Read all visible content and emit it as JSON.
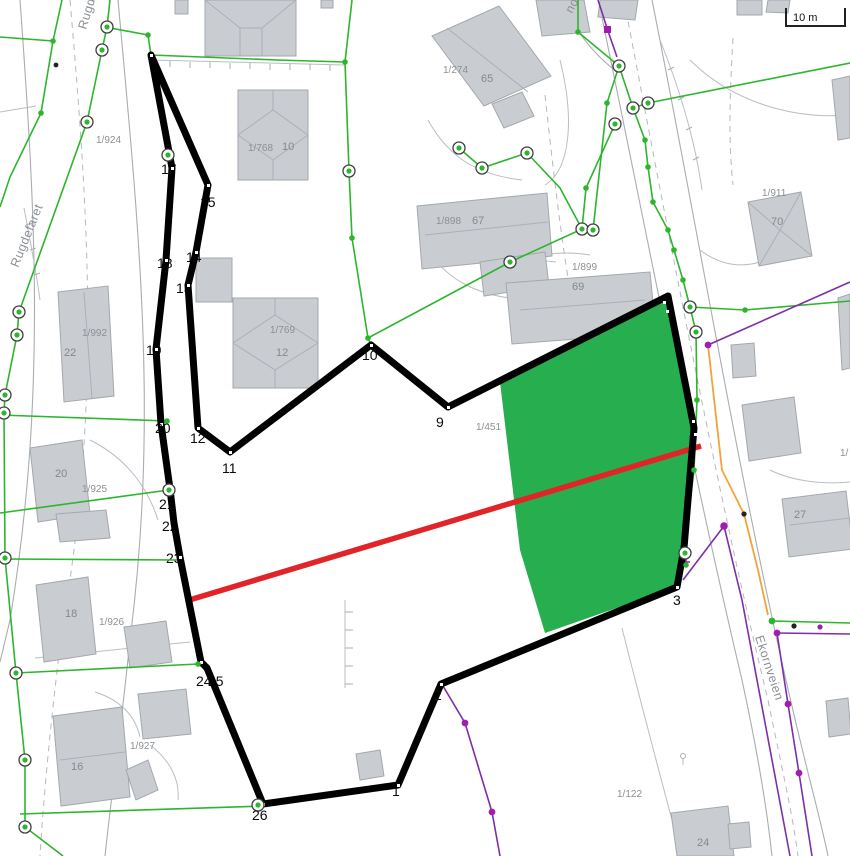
{
  "map": {
    "scale_bar_label": "10 m",
    "street_labels": [
      "Rugdefaret",
      "Rugdefaret",
      "Ekornveien",
      "nd"
    ],
    "parcels": [
      "1/924",
      "1/992",
      "1/769",
      "1/768",
      "1/274",
      "1/898",
      "1/899",
      "1/911",
      "1/925",
      "1/926",
      "1/927",
      "1/122",
      "1/451",
      "1/"
    ],
    "house_numbers": [
      "22",
      "12",
      "10",
      "65",
      "67",
      "69",
      "70",
      "20",
      "18",
      "16",
      "27",
      "24"
    ],
    "boundary_vertices_partially_hidden": [
      "13",
      "14",
      "15",
      "17",
      "18",
      "19",
      "21",
      "22",
      "23",
      "25"
    ],
    "boundary_vertices_visible": [
      "20",
      "12",
      "11",
      "10",
      "9",
      "1",
      "2",
      "3",
      "24",
      "26"
    ],
    "colors": {
      "measured_boundary": "#000000",
      "highlighted_area_fill": "#27ae4e",
      "section_line_red": "#e02428",
      "cadastre_green": "#2db52d",
      "utility_purple": "#7d2fa8",
      "utility_orange": "#f0a43c",
      "building_fill": "#c9cdd1",
      "label_gray": "#8c9094"
    }
  }
}
